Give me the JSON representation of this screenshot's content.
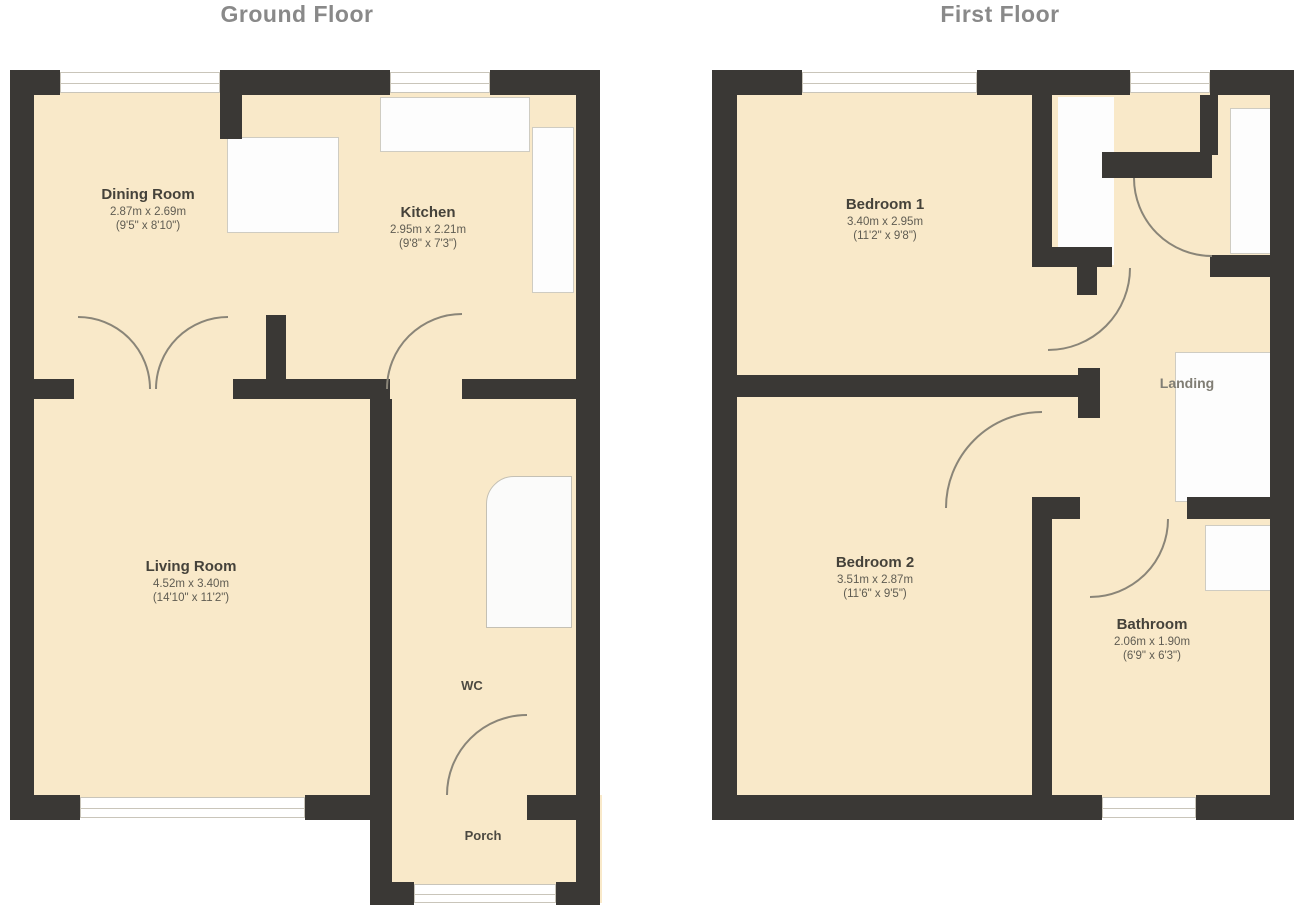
{
  "document": {
    "type": "floorplan",
    "background": "#ffffff"
  },
  "colors": {
    "floor_fill": "#f9e9c9",
    "wall": "#3a3835",
    "door_arc": "#8a8578",
    "window_line": "#c9c5ba",
    "room_name_text": "#45423a",
    "dims_text": "#5f5c52",
    "title_text": "#898989"
  },
  "plans": [
    {
      "title": "Ground Floor",
      "rooms": [
        {
          "name": "Dining Room",
          "dims": "2.87m x 2.69m",
          "dims2": "(9'5\" x 8'10\")"
        },
        {
          "name": "Kitchen",
          "dims": "2.95m x 2.21m",
          "dims2": "(9'8\" x 7'3\")"
        },
        {
          "name": "Living Room",
          "dims": "4.52m x 3.40m",
          "dims2": "(14'10\" x 11'2\")"
        },
        {
          "name": "WC"
        },
        {
          "name": "Porch"
        }
      ]
    },
    {
      "title": "First Floor",
      "rooms": [
        {
          "name": "Bedroom 1",
          "dims": "3.40m x 2.95m",
          "dims2": "(11'2\" x 9'8\")"
        },
        {
          "name": "Bedroom 2",
          "dims": "3.51m x 2.87m",
          "dims2": "(11'6\" x 9'5\")"
        },
        {
          "name": "Bathroom",
          "dims": "2.06m x 1.90m",
          "dims2": "(6'9\" x 6'3\")"
        },
        {
          "name": "Landing"
        }
      ]
    }
  ]
}
